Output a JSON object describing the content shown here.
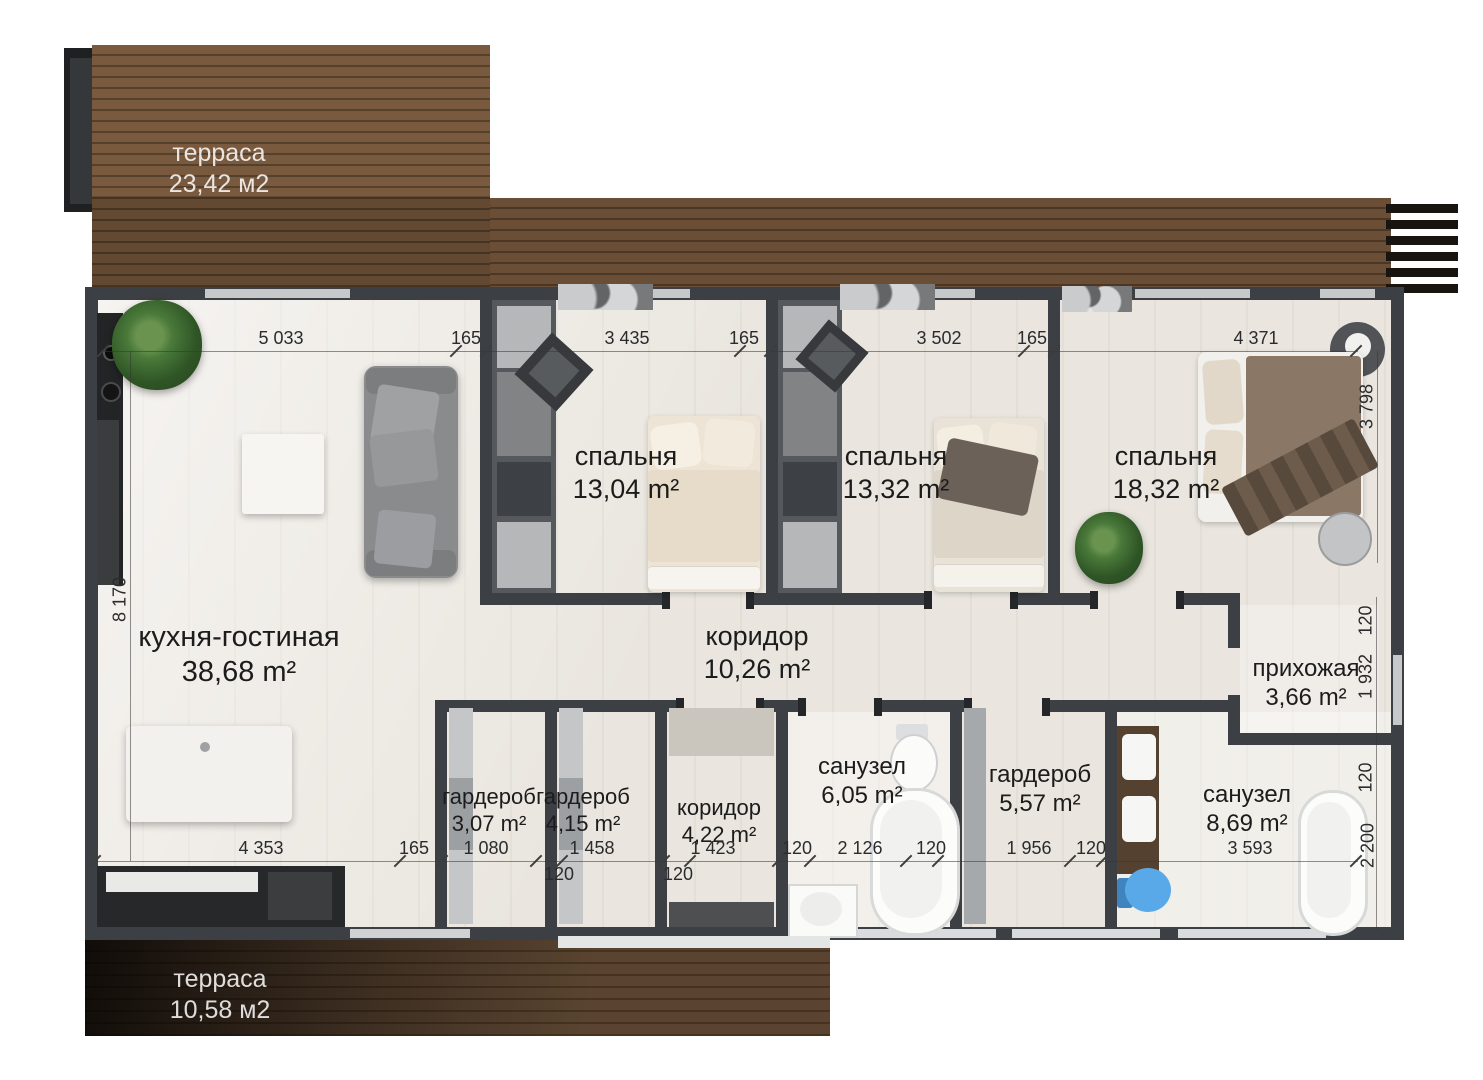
{
  "plan": {
    "terrace_top": {
      "name": "терраса",
      "area": "23,42 м2"
    },
    "terrace_bottom": {
      "name": "терраса",
      "area": "10,58 м2"
    },
    "rooms": {
      "kitchen_living": {
        "name": "кухня-гостиная",
        "area": "38,68 m²"
      },
      "bedroom1": {
        "name": "спальня",
        "area": "13,04 m²"
      },
      "bedroom2": {
        "name": "спальня",
        "area": "13,32 m²"
      },
      "bedroom3": {
        "name": "спальня",
        "area": "18,32 m²"
      },
      "corridor_main": {
        "name": "коридор",
        "area": "10,26 m²"
      },
      "hallway": {
        "name": "прихожая",
        "area": "3,66 m²"
      },
      "wardrobe1": {
        "name": "гардероб",
        "area": "3,07 m²"
      },
      "wardrobe2": {
        "name": "гардероб",
        "area": "4,15 m²"
      },
      "corridor2": {
        "name": "коридор",
        "area": "4,22 m²"
      },
      "bathroom1": {
        "name": "санузел",
        "area": "6,05 m²"
      },
      "wardrobe3": {
        "name": "гардероб",
        "area": "5,57 m²"
      },
      "bathroom2": {
        "name": "санузел",
        "area": "8,69 m²"
      }
    },
    "dims": {
      "top": [
        "5 033",
        "165",
        "3 435",
        "165",
        "3 502",
        "165",
        "4 371"
      ],
      "bottom": [
        "4 353",
        "165",
        "1 080",
        "1 458",
        "1 423",
        "120",
        "2 126",
        "120",
        "1 956",
        "120",
        "3 593"
      ],
      "bottom_sub": [
        "120",
        "120"
      ],
      "left": [
        "8 170"
      ],
      "right_bed": [
        "3 798"
      ],
      "right_col": [
        "120",
        "1 932",
        "120",
        "2 200"
      ]
    },
    "colors": {
      "wall": "#3c3f43",
      "wood_light": "#7a5a3e",
      "wood_dark": "#47351f",
      "floor": "#eae6df",
      "toilet_blue": "#59a8e8"
    }
  }
}
